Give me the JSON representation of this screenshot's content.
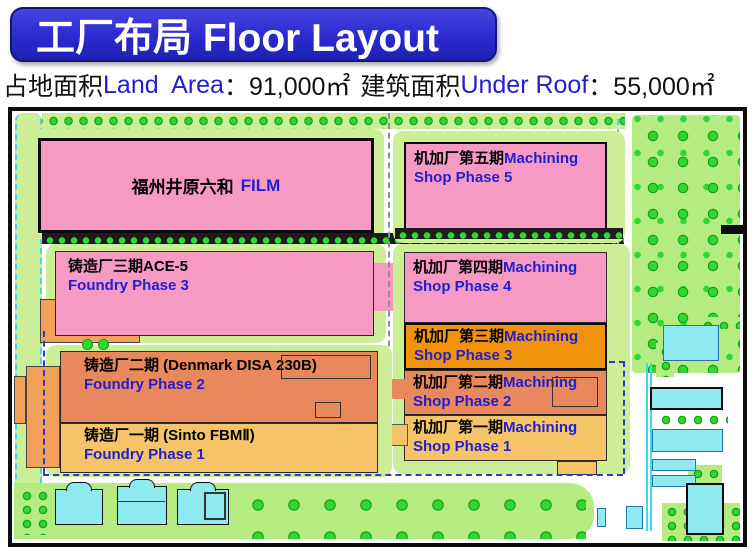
{
  "title": "工厂布局 Floor Layout",
  "stats": {
    "land_zh": "占地面积",
    "land_en": "Land  Area",
    "land_value": "：91,000㎡",
    "roof_zh": "建筑面积",
    "roof_en": "Under Roof",
    "roof_value": "：55,000㎡"
  },
  "map": {
    "film": {
      "zh": "福州井原六和",
      "en": "FILM"
    },
    "foundries": [
      {
        "zh": "铸造厂三期ACE-5",
        "en": "Foundry Phase 3"
      },
      {
        "zh": "铸造厂二期 (Denmark DISA 230B)",
        "en": "Foundry Phase 2"
      },
      {
        "zh": "铸造厂一期 (Sinto FBMⅡ)",
        "en": "Foundry Phase 1"
      }
    ],
    "machining": [
      {
        "zh": "机加厂第五期",
        "en": "Machining",
        "en2": "Shop Phase 5"
      },
      {
        "zh": "机加厂第四期",
        "en": "Machining",
        "en2": "Shop Phase 4"
      },
      {
        "zh": "机加厂第三期",
        "en": "Machining",
        "en2": "Shop Phase 3"
      },
      {
        "zh": "机加厂第二期",
        "en": "Machining",
        "en2": "Shop Phase 2"
      },
      {
        "zh": "机加厂第一期",
        "en": "Machining",
        "en2": "Shop Phase 1"
      }
    ]
  },
  "colors": {
    "banner1": "#4545e0",
    "banner2": "#2a2ace",
    "banner3": "#2020b4",
    "bannerBorder": "#15157e",
    "bluetext": "#2020cf",
    "ink": "#111111",
    "pink": "#f79ac3",
    "orange": "#f1930a",
    "salmon": "#e8885c",
    "amber": "#f6c468",
    "annex": "#f2a05a",
    "leaf": "#cbee96",
    "grass": "#b4ec82",
    "tree": "#2fd732",
    "treedark": "#15a015",
    "cyanfill": "#8fe9f0",
    "cyanline": "#42d8e8",
    "navy": "#2f3bbf"
  }
}
